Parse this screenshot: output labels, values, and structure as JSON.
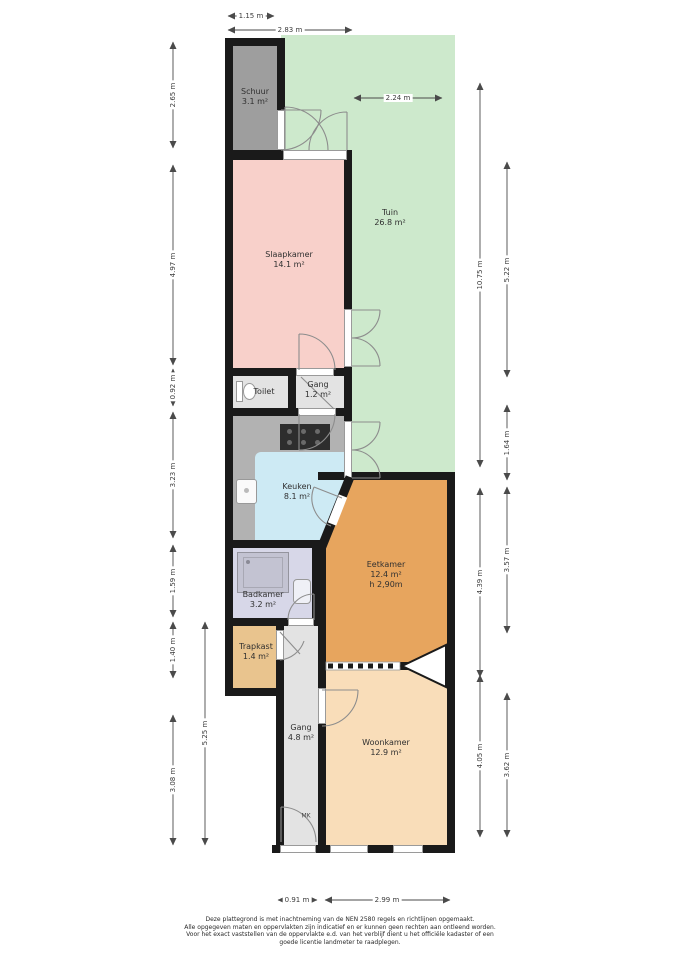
{
  "rooms": {
    "schuur": {
      "name": "Schuur",
      "area": "3.1 m²"
    },
    "tuin": {
      "name": "Tuin",
      "area": "26.8 m²"
    },
    "slaapkamer": {
      "name": "Slaapkamer",
      "area": "14.1 m²"
    },
    "toilet": {
      "name": "Toilet"
    },
    "gang_klein": {
      "name": "Gang",
      "area": "1.2 m²"
    },
    "keuken": {
      "name": "Keuken",
      "area": "8.1 m²"
    },
    "badkamer": {
      "name": "Badkamer",
      "area": "3.2 m²"
    },
    "eetkamer": {
      "name": "Eetkamer",
      "area": "12.4 m²",
      "note": "h 2,90m"
    },
    "trapkast": {
      "name": "Trapkast",
      "area": "1.4 m²"
    },
    "gang": {
      "name": "Gang",
      "area": "4.8 m²"
    },
    "woonkamer": {
      "name": "Woonkamer",
      "area": "12.9 m²"
    },
    "meterkast": {
      "abbr": "MK"
    }
  },
  "dimensions": {
    "d115": "1.15 m",
    "d283": "2.83 m",
    "d224": "2.24 m",
    "d265": "2.65 m",
    "d497": "4.97 m",
    "d092": "0.92 m",
    "d323": "3.23 m",
    "d159": "1.59 m",
    "d140": "1.40 m",
    "d308": "3.08 m",
    "d525": "5.25 m",
    "d1075": "10.75 m",
    "d522": "5.22 m",
    "d164": "1.64 m",
    "d439": "4.39 m",
    "d357": "3.57 m",
    "d405": "4.05 m",
    "d362": "3.62 m",
    "d091": "0.91 m",
    "d299": "2.99 m"
  },
  "colors": {
    "wall": "#1a1a1a",
    "garden": "#cde9cc",
    "shed": "#9e9e9e",
    "bedroom": "#f8d0ca",
    "kitchen": "#cdeaf4",
    "kitchen_counter": "#b2b2b2",
    "bathroom": "#d7d7e8",
    "dining": "#e7a55e",
    "living": "#f9ddb9",
    "closet": "#e9c48e",
    "hall": "#e3e3e3"
  },
  "disclaimer": {
    "line1": "Deze plattegrond is met inachtneming van de NEN 2580 regels en richtlijnen opgemaakt.",
    "line2": "Alle opgegeven maten en oppervlakten zijn indicatief en er kunnen geen rechten aan ontleend worden.",
    "line3": "Voor het exact vaststellen van de oppervlakte e.d. van het verblijf dient u het officiële kadaster of een",
    "line4": "goede licentie landmeter te raadplegen."
  }
}
